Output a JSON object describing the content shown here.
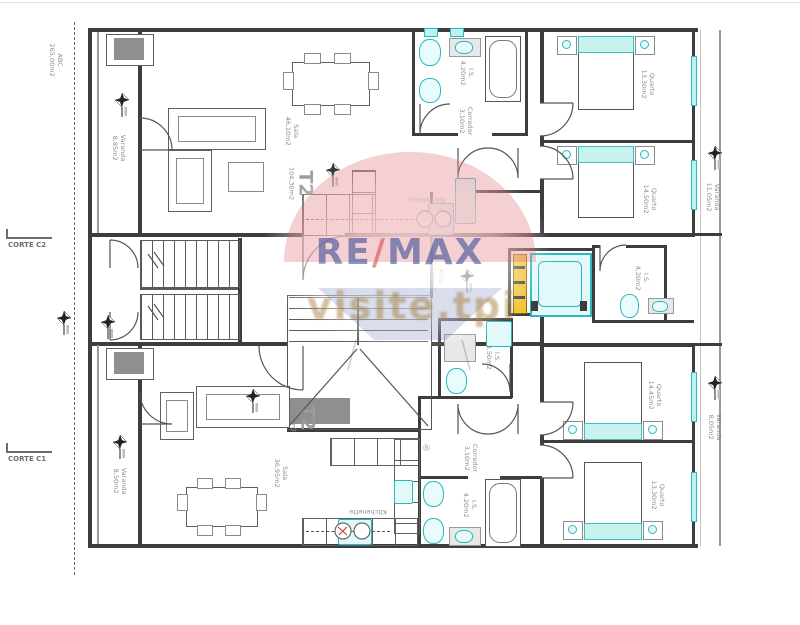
{
  "colors": {
    "wall": "#3d3d3d",
    "fixture_teal": "#2ab8c0",
    "shaft_yellow": "#f2c12e",
    "label_grey": "#8c8c8c",
    "balloon_red": "#d9565e",
    "brand_blue": "#2b4394",
    "tagline_tan": "#a8813f"
  },
  "watermark": {
    "brand_re": "RE",
    "brand_slash": "/",
    "brand_max": "MAX",
    "tagline": "visite.tpi",
    "registered": "®"
  },
  "annotations": {
    "abc_line1": "ABC",
    "abc_line2": "265,00m2",
    "corte_c2": "CORTE C2",
    "corte_c1": "CORTE C1"
  },
  "units": {
    "top": {
      "t2": {
        "name": "T2",
        "area": "104,30m2"
      },
      "sala": {
        "name": "Sala",
        "area": "46,10m2"
      },
      "kitchenette": "Kitchenette",
      "corredor": {
        "name": "Corredor",
        "area": "3,10m2"
      },
      "is_main": {
        "name": "I.S.",
        "area": "4,20m2"
      },
      "quarto1": {
        "name": "Quarto",
        "area": "13,30m2"
      },
      "quarto2": {
        "name": "Quarto",
        "area": "14,50m2"
      },
      "varanda_left": {
        "name": "Varanda",
        "area": "8,85m2"
      },
      "varanda_right": {
        "name": "Varanda",
        "area": "11,05m2"
      }
    },
    "common": {
      "atrio": {
        "name": "Átrio",
        "area": "27,05m2"
      },
      "is_mid": {
        "name": "I.S.",
        "area": "4,20m2"
      }
    },
    "bottom": {
      "t2": {
        "name": "T2",
        "area": "93,75m2"
      },
      "sala": {
        "name": "Sala",
        "area": "36,95m2"
      },
      "kitchenette": "Kitchenette",
      "corredor": {
        "name": "Corredor",
        "area": "3,10m2"
      },
      "is_main": {
        "name": "I.S.",
        "area": "4,20m2"
      },
      "is_small": {
        "name": "I.S.",
        "area": "3,50m2"
      },
      "quarto1": {
        "name": "Quarto",
        "area": "14,45m2"
      },
      "quarto2": {
        "name": "Quarto",
        "area": "13,30m2"
      },
      "varanda_left": {
        "name": "Varanda",
        "area": "8,50m2"
      },
      "varanda_right": {
        "name": "Varanda",
        "area": "8,05m2"
      }
    }
  }
}
